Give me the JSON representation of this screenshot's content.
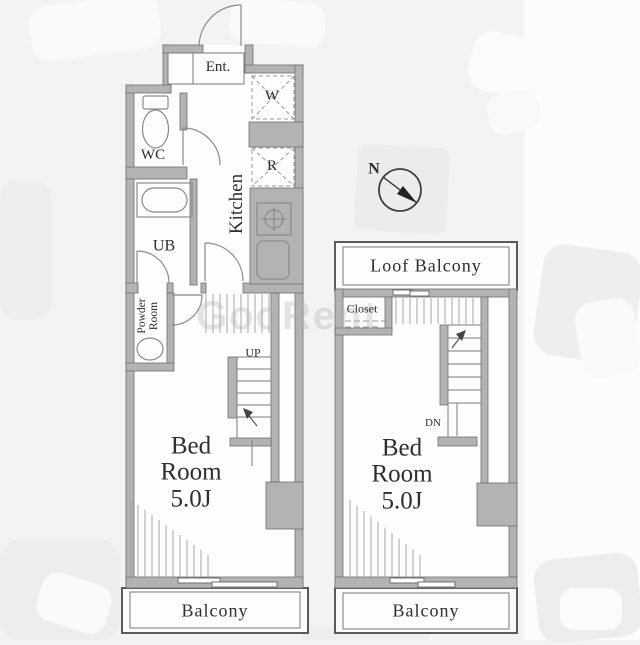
{
  "floor1": {
    "entrance_label": "Ent.",
    "wc_label": "WC",
    "ub_label": "UB",
    "powder_line1": "Powder",
    "powder_line2": "Room",
    "kitchen_label": "Kitchen",
    "washer_label": "W",
    "fridge_label": "R",
    "stairs_label": "UP",
    "bedroom_line1": "Bed",
    "bedroom_line2": "Room",
    "bedroom_line3": "5.0J",
    "balcony_label": "Balcony"
  },
  "floor2": {
    "roof_balcony_label": "Loof Balcony",
    "closet_label": "Closet",
    "stairs_label": "DN",
    "bedroom_line1": "Bed",
    "bedroom_line2": "Room",
    "bedroom_line3": "5.0J",
    "balcony_label": "Balcony"
  },
  "compass": {
    "north_label": "N"
  },
  "watermark": "GooRent",
  "colors": {
    "wall": "#b3b3b3",
    "wall_edge": "#6f6f6f",
    "line": "#8a8a8a",
    "text": "#2e2e2e",
    "background": "#f3f3f3"
  }
}
